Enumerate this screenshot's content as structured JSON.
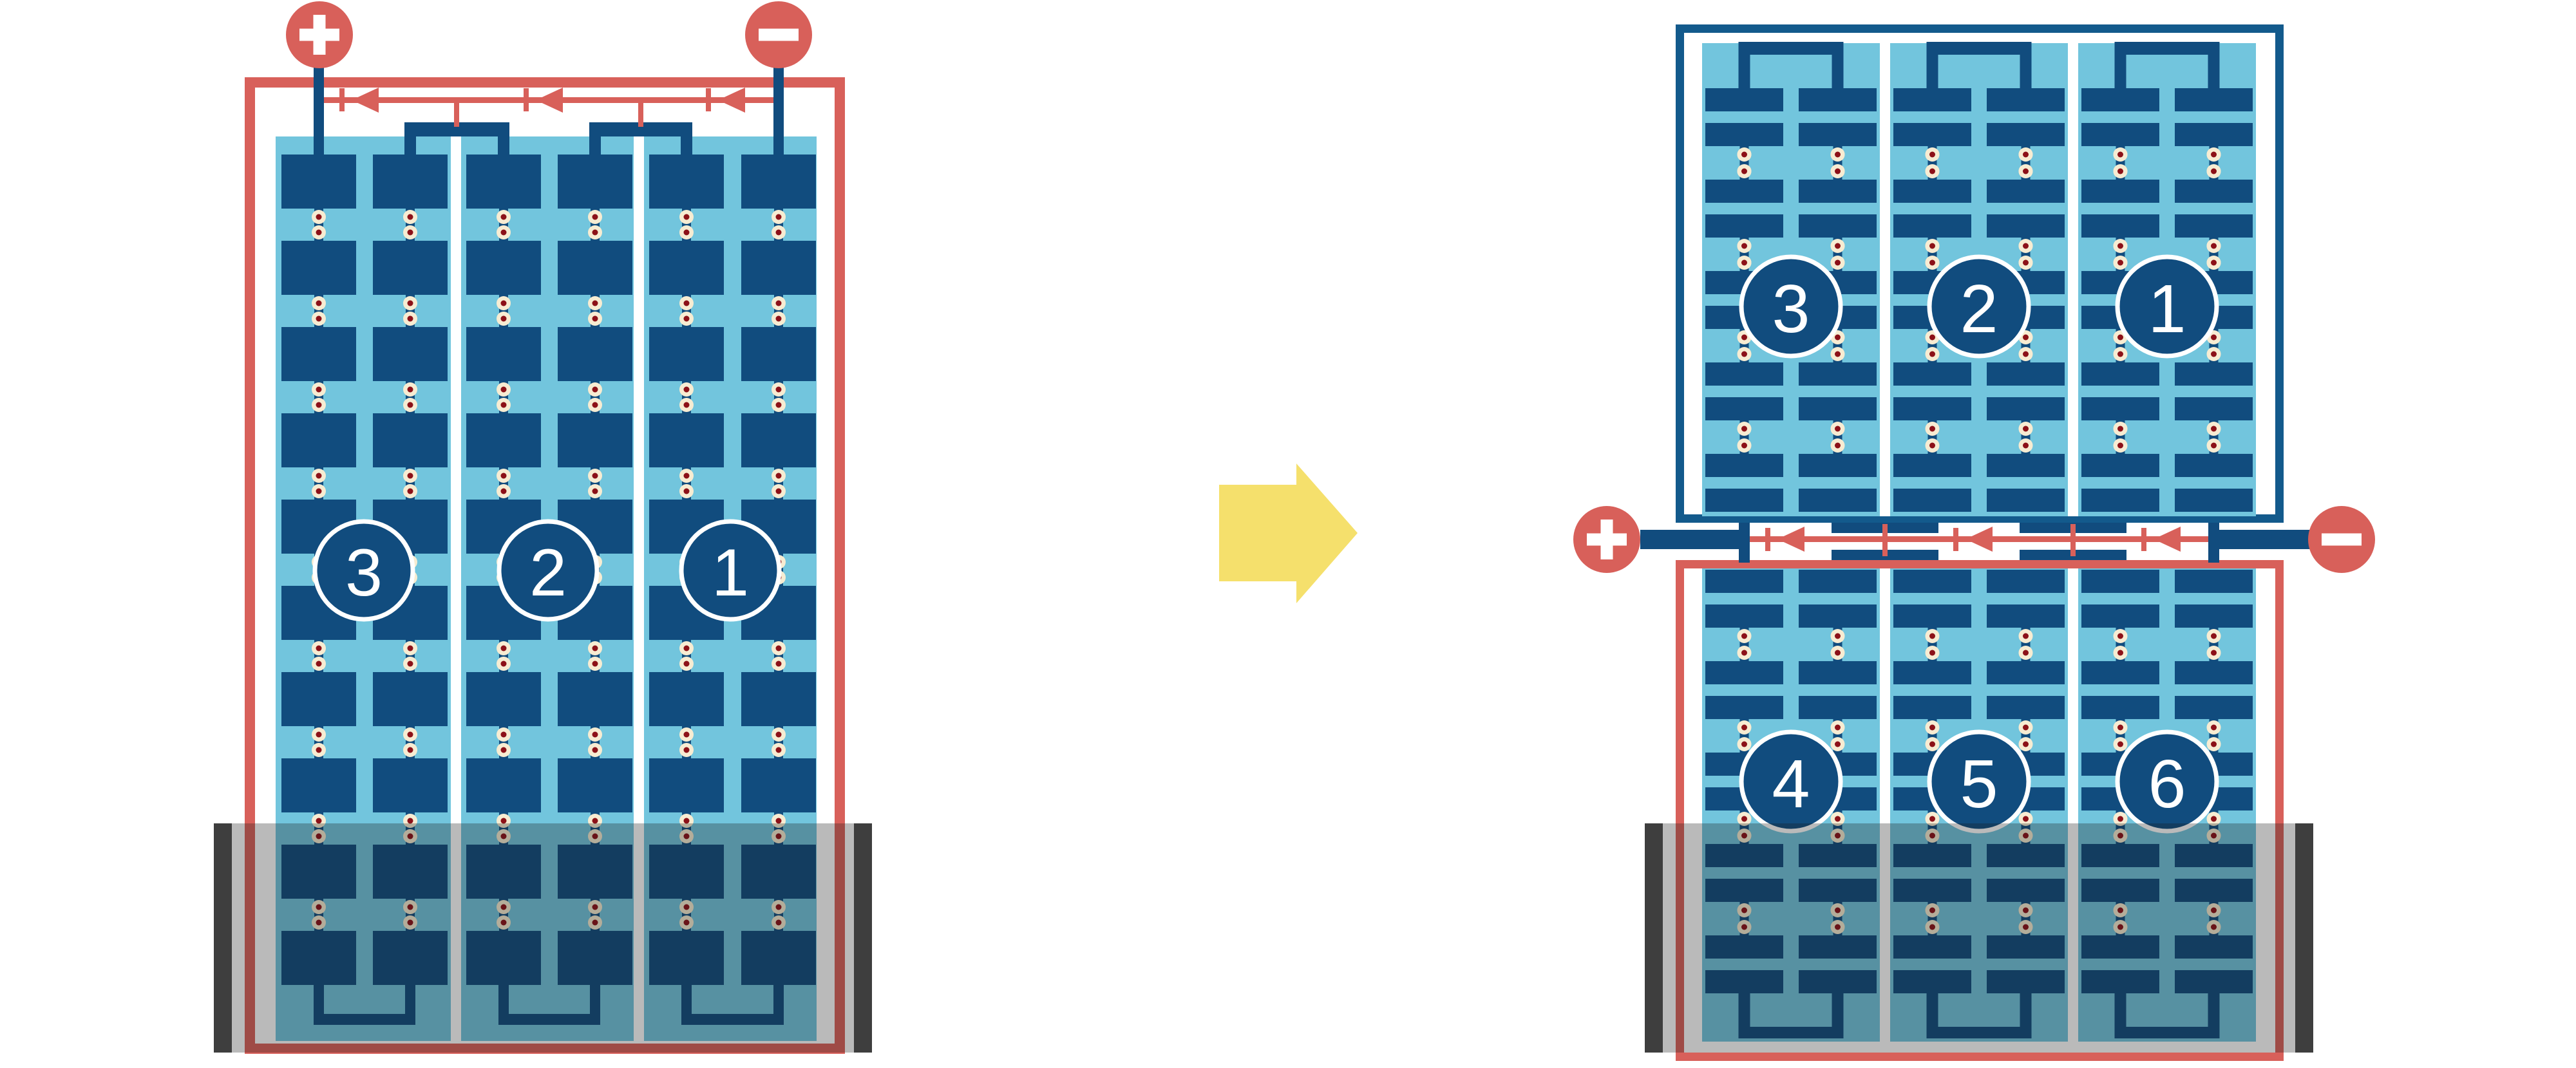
{
  "colors": {
    "salmon": "#D8605A",
    "navy_plate": "#114C7E",
    "navy_case": "#135A8C",
    "light_blue": "#72C5DD",
    "cream": "#F7ECD2",
    "rivet_dot": "#8C1118",
    "separator_white": "#FFFFFF",
    "flood_overlay": "rgba(25,25,25,0.30)",
    "flood_edge_bar": "#3E3E3E",
    "arrow_yellow": "#F5E06C",
    "badge_text": "#FFFFFF",
    "background": "#FFFFFF"
  },
  "left_battery": {
    "positive_terminal": {
      "symbol": "+"
    },
    "negative_terminal": {
      "symbol": "−"
    },
    "cells": [
      {
        "label": "3"
      },
      {
        "label": "2"
      },
      {
        "label": "1"
      }
    ]
  },
  "transform_arrow": {
    "direction": "right"
  },
  "right_stack": {
    "top_battery": {
      "cells": [
        {
          "label": "3"
        },
        {
          "label": "2"
        },
        {
          "label": "1"
        }
      ]
    },
    "bottom_battery": {
      "cells": [
        {
          "label": "4"
        },
        {
          "label": "5"
        },
        {
          "label": "6"
        }
      ]
    },
    "positive_terminal": {
      "symbol": "+"
    },
    "negative_terminal": {
      "symbol": "−"
    }
  }
}
